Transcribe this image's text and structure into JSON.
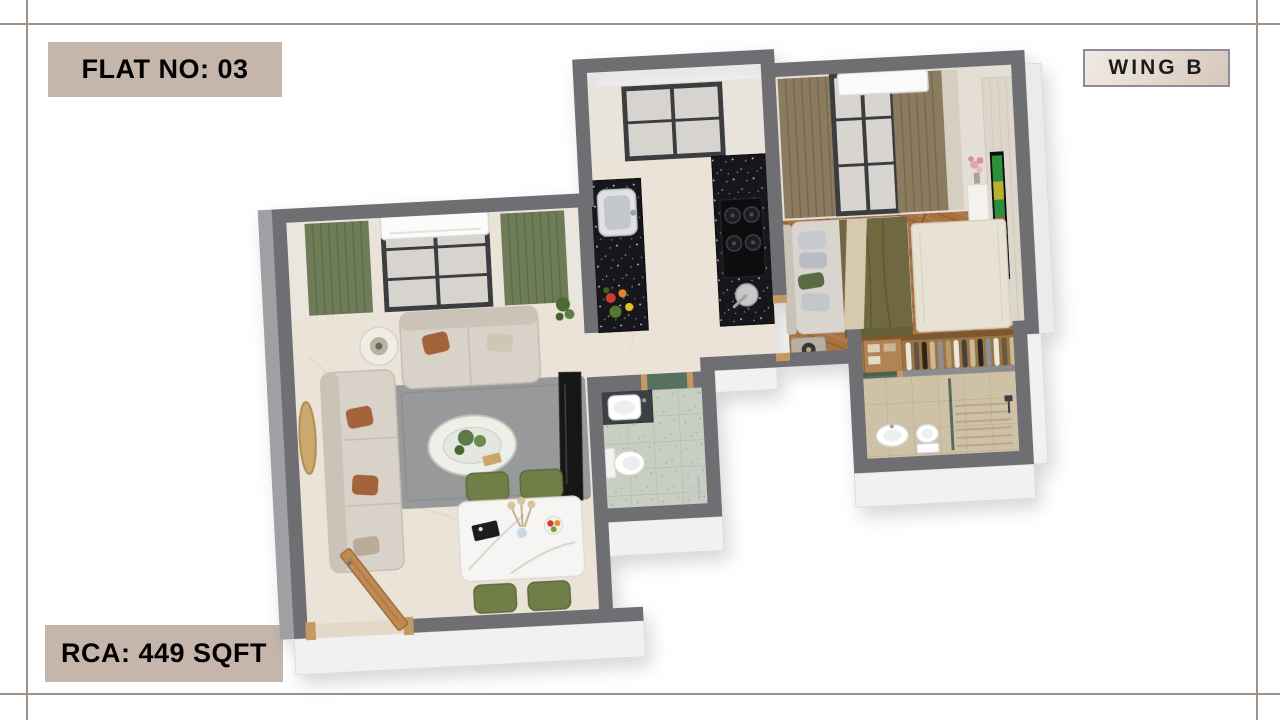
{
  "page": {
    "background": "#ffffff"
  },
  "frame": {
    "line_color": "#a2918b"
  },
  "labels": {
    "flat_no": {
      "text": "FLAT NO: 03",
      "bg": "#c6b5aa",
      "text_color": "#000000"
    },
    "wing": {
      "text": "WING B",
      "bg_from": "#f2ebe3",
      "bg_to": "#d5c7bc",
      "border": "#8d8c98",
      "text_color": "#1b1b1d"
    },
    "rca": {
      "text": "RCA: 449 SQFT",
      "bg": "#c6b5aa",
      "text_color": "#000000"
    }
  },
  "floor_plan": {
    "view": "3D isometric apartment render",
    "rooms": [
      "living room",
      "dining area",
      "kitchen",
      "foyer",
      "bedroom",
      "wardrobe",
      "master bathroom",
      "common bathroom"
    ],
    "palette": {
      "wall": "#6e6e73",
      "wall_face_white": "#f2f1ef",
      "floor_marble": "#ebe3d8",
      "floor_wood": "#a8713f",
      "floor_tile_common": "#c9cec2",
      "floor_tile_master": "#cfc1a6",
      "counter_granite": "#16181d",
      "sofa_beige": "#d9d2c8",
      "curtain_green": "#6d7b57",
      "curtain_brown": "#8b7b61",
      "chair_green": "#6f7f47",
      "accent_rust": "#a5643a",
      "bed_blanket_olive": "#6f6840",
      "door_wood": "#c08a52",
      "glass_green": "#3f5d4b"
    }
  }
}
